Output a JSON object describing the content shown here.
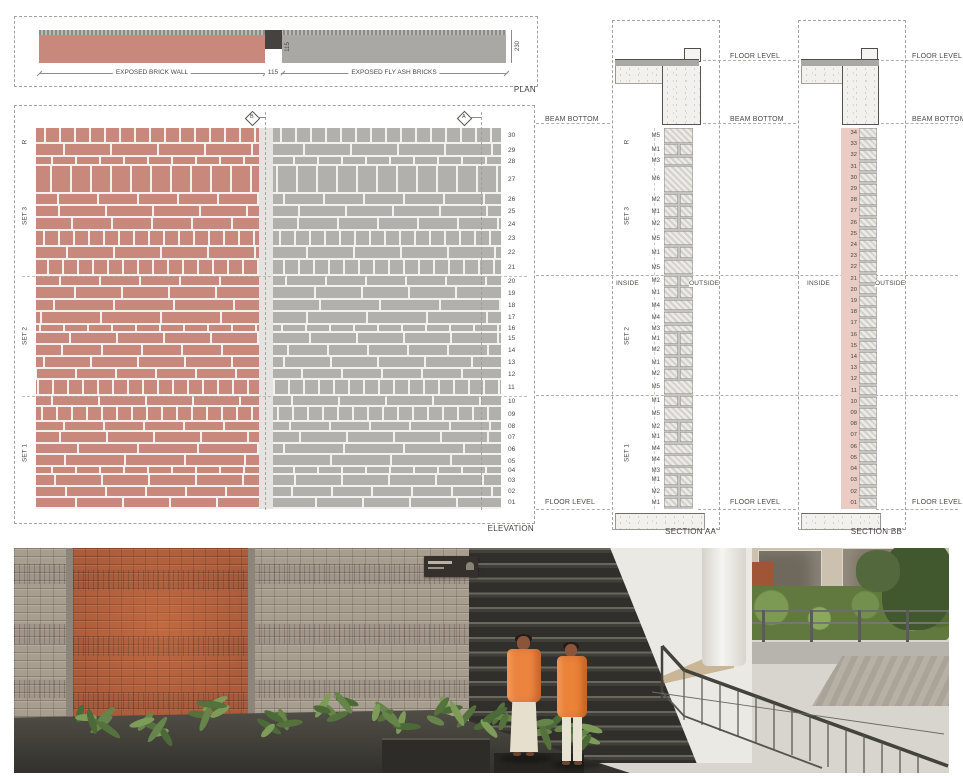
{
  "sheet": {
    "plan_title": "PLAN",
    "elevation_title": "ELEVATION",
    "section_aa_title": "SECTION AA'",
    "section_bb_title": "SECTION BB'"
  },
  "plan": {
    "brick_wall_label": "EXPOSED BRICK WALL",
    "fly_ash_label": "EXPOSED FLY ASH BRICKS",
    "dim_joint": "115",
    "dim_offset": "115",
    "dim_thickness": "230"
  },
  "levels": {
    "floor_level": "FLOOR LEVEL",
    "beam_bottom": "BEAM BOTTOM"
  },
  "orientation": {
    "inside": "INSIDE",
    "outside": "OUTSIDE"
  },
  "elevation": {
    "marker_a": "A",
    "marker_b": "B"
  },
  "groups": [
    {
      "label": "R",
      "count": 2
    },
    {
      "label": "SET 3",
      "count": 8
    },
    {
      "label": "SET 2",
      "count": 10
    },
    {
      "label": "SET 1",
      "count": 10
    }
  ],
  "courses": [
    {
      "no": "30",
      "mark": "M5"
    },
    {
      "no": "29",
      "mark": "M1"
    },
    {
      "no": "28",
      "mark": "M3"
    },
    {
      "no": "27",
      "mark": "M6"
    },
    {
      "no": "26",
      "mark": "M2"
    },
    {
      "no": "25",
      "mark": "M1"
    },
    {
      "no": "24",
      "mark": "M2"
    },
    {
      "no": "23",
      "mark": "M5"
    },
    {
      "no": "22",
      "mark": "M1"
    },
    {
      "no": "21",
      "mark": "M5"
    },
    {
      "no": "20",
      "mark": "M2"
    },
    {
      "no": "19",
      "mark": "M1"
    },
    {
      "no": "18",
      "mark": "M4"
    },
    {
      "no": "17",
      "mark": "M4"
    },
    {
      "no": "16",
      "mark": "M3"
    },
    {
      "no": "15",
      "mark": "M1"
    },
    {
      "no": "14",
      "mark": "M2"
    },
    {
      "no": "13",
      "mark": "M1"
    },
    {
      "no": "12",
      "mark": "M2"
    },
    {
      "no": "11",
      "mark": "M5"
    },
    {
      "no": "10",
      "mark": "M1"
    },
    {
      "no": "09",
      "mark": "M5"
    },
    {
      "no": "08",
      "mark": "M2"
    },
    {
      "no": "07",
      "mark": "M1"
    },
    {
      "no": "06",
      "mark": "M4"
    },
    {
      "no": "05",
      "mark": "M4"
    },
    {
      "no": "04",
      "mark": "M3"
    },
    {
      "no": "03",
      "mark": "M1"
    },
    {
      "no": "02",
      "mark": "M2"
    },
    {
      "no": "01",
      "mark": "M1"
    }
  ],
  "section_bb_rows": [
    "34",
    "33",
    "32",
    "31",
    "30",
    "29",
    "28",
    "27",
    "26",
    "25",
    "24",
    "23",
    "22",
    "21",
    "20",
    "19",
    "18",
    "17",
    "16",
    "15",
    "14",
    "13",
    "12",
    "11",
    "10",
    "09",
    "08",
    "07",
    "06",
    "05",
    "04",
    "03",
    "02",
    "01"
  ],
  "colors": {
    "red_brick": "#c8897c",
    "gray_brick": "#b2b0ad",
    "plan_dark": "#454240",
    "section_pink": "#eaccc5",
    "photo_orange": "#ec8440"
  }
}
